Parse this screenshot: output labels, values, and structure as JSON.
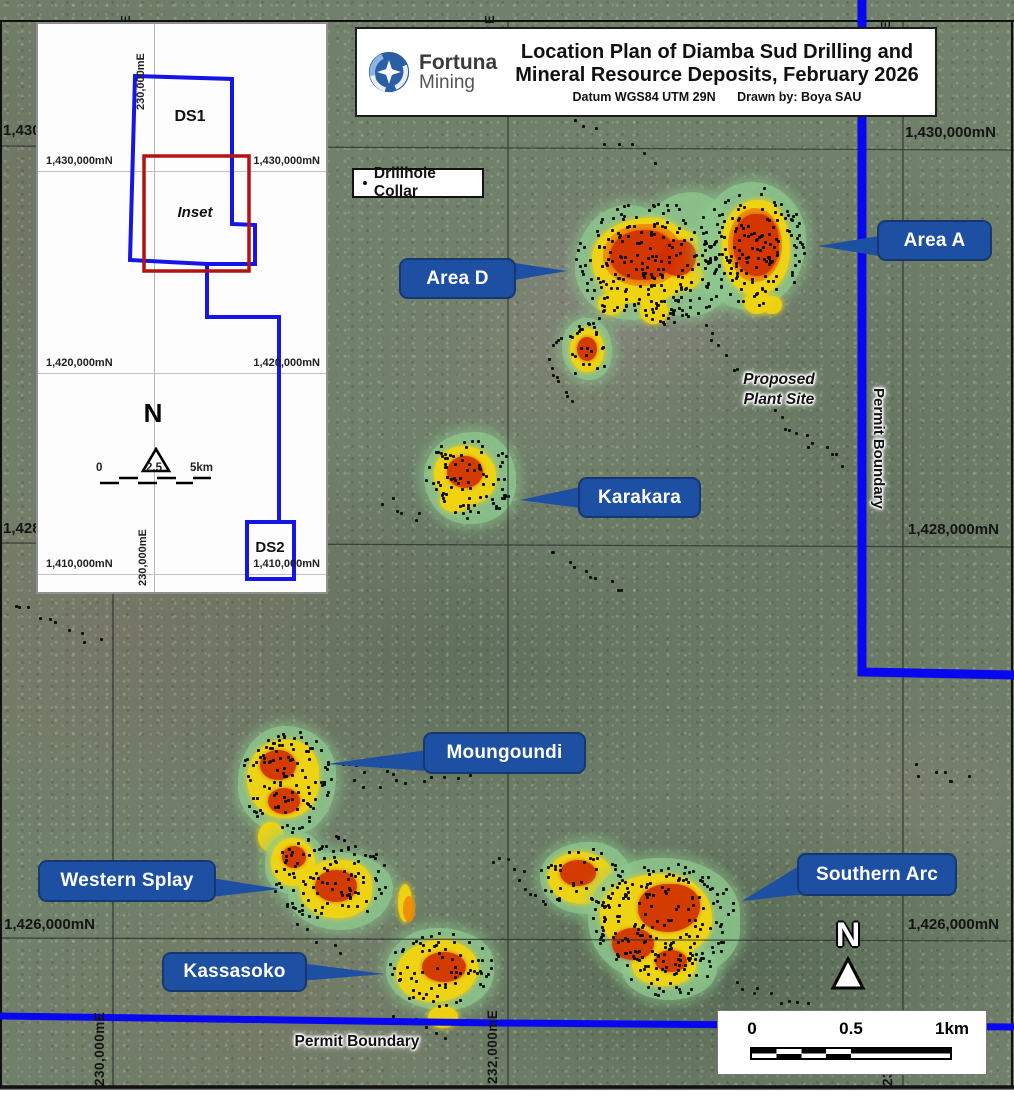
{
  "title_block": {
    "logo_line1": "Fortuna",
    "logo_line2": "Mining",
    "title_line1": "Location Plan of Diamba Sud Drilling and",
    "title_line2": "Mineral Resource Deposits, February 2026",
    "datum": "Datum WGS84 UTM 29N",
    "drawn_by": "Drawn by: Boya SAU"
  },
  "legend": {
    "drillhole_collar": "Drillhole Collar"
  },
  "inset": {
    "ds1": "DS1",
    "ds2": "DS2",
    "label": "Inset",
    "north": "N",
    "easting_top": "230,000mE",
    "easting_bottom": "230,000mE",
    "northing_1430_left": "1,430,000mN",
    "northing_1430_right": "1,430,000mN",
    "northing_1420_left": "1,420,000mN",
    "northing_1420_right": "1,420,000mN",
    "northing_1410_left": "1,410,000mN",
    "northing_1410_right": "1,410,000mN",
    "scale_start": "0",
    "scale_mid": "2.5",
    "scale_end": "5km"
  },
  "callouts": {
    "area_a": "Area A",
    "area_d": "Area D",
    "karakara": "Karakara",
    "moungoundi": "Moungoundi",
    "western_splay": "Western Splay",
    "kassasoko": "Kassasoko",
    "southern_arc": "Southern Arc"
  },
  "annotations": {
    "proposed_plant_line1": "Proposed",
    "proposed_plant_line2": "Plant Site",
    "permit_boundary_right": "Permit Boundary",
    "permit_boundary_bottom": "Permit Boundary"
  },
  "grid": {
    "northing_1430_left": "1,430,000mN",
    "northing_1430_right": "1,430,000mN",
    "northing_1428_left": "1,428,000mN",
    "northing_1428_right": "1,428,000mN",
    "northing_1426_left": "1,426,000mN",
    "northing_1426_right": "1,426,000mN",
    "easting_230": "230,000mE",
    "easting_232": "232,000mE",
    "easting_234_partial": "234,000mE",
    "easting_partial_top": "E"
  },
  "map_furniture": {
    "north": "N",
    "scale_start": "0",
    "scale_mid": "0.5",
    "scale_end": "1km"
  },
  "colors": {
    "permit_boundary_blue": "#0808f0",
    "callout_blue": "#1d4fa3",
    "deposit_green": "#8ec88e",
    "mineral_yellow": "#f3d50e",
    "mineral_red": "#d22f00",
    "inset_outline_blue": "#1515e8",
    "inset_rect_red": "#b51212"
  }
}
